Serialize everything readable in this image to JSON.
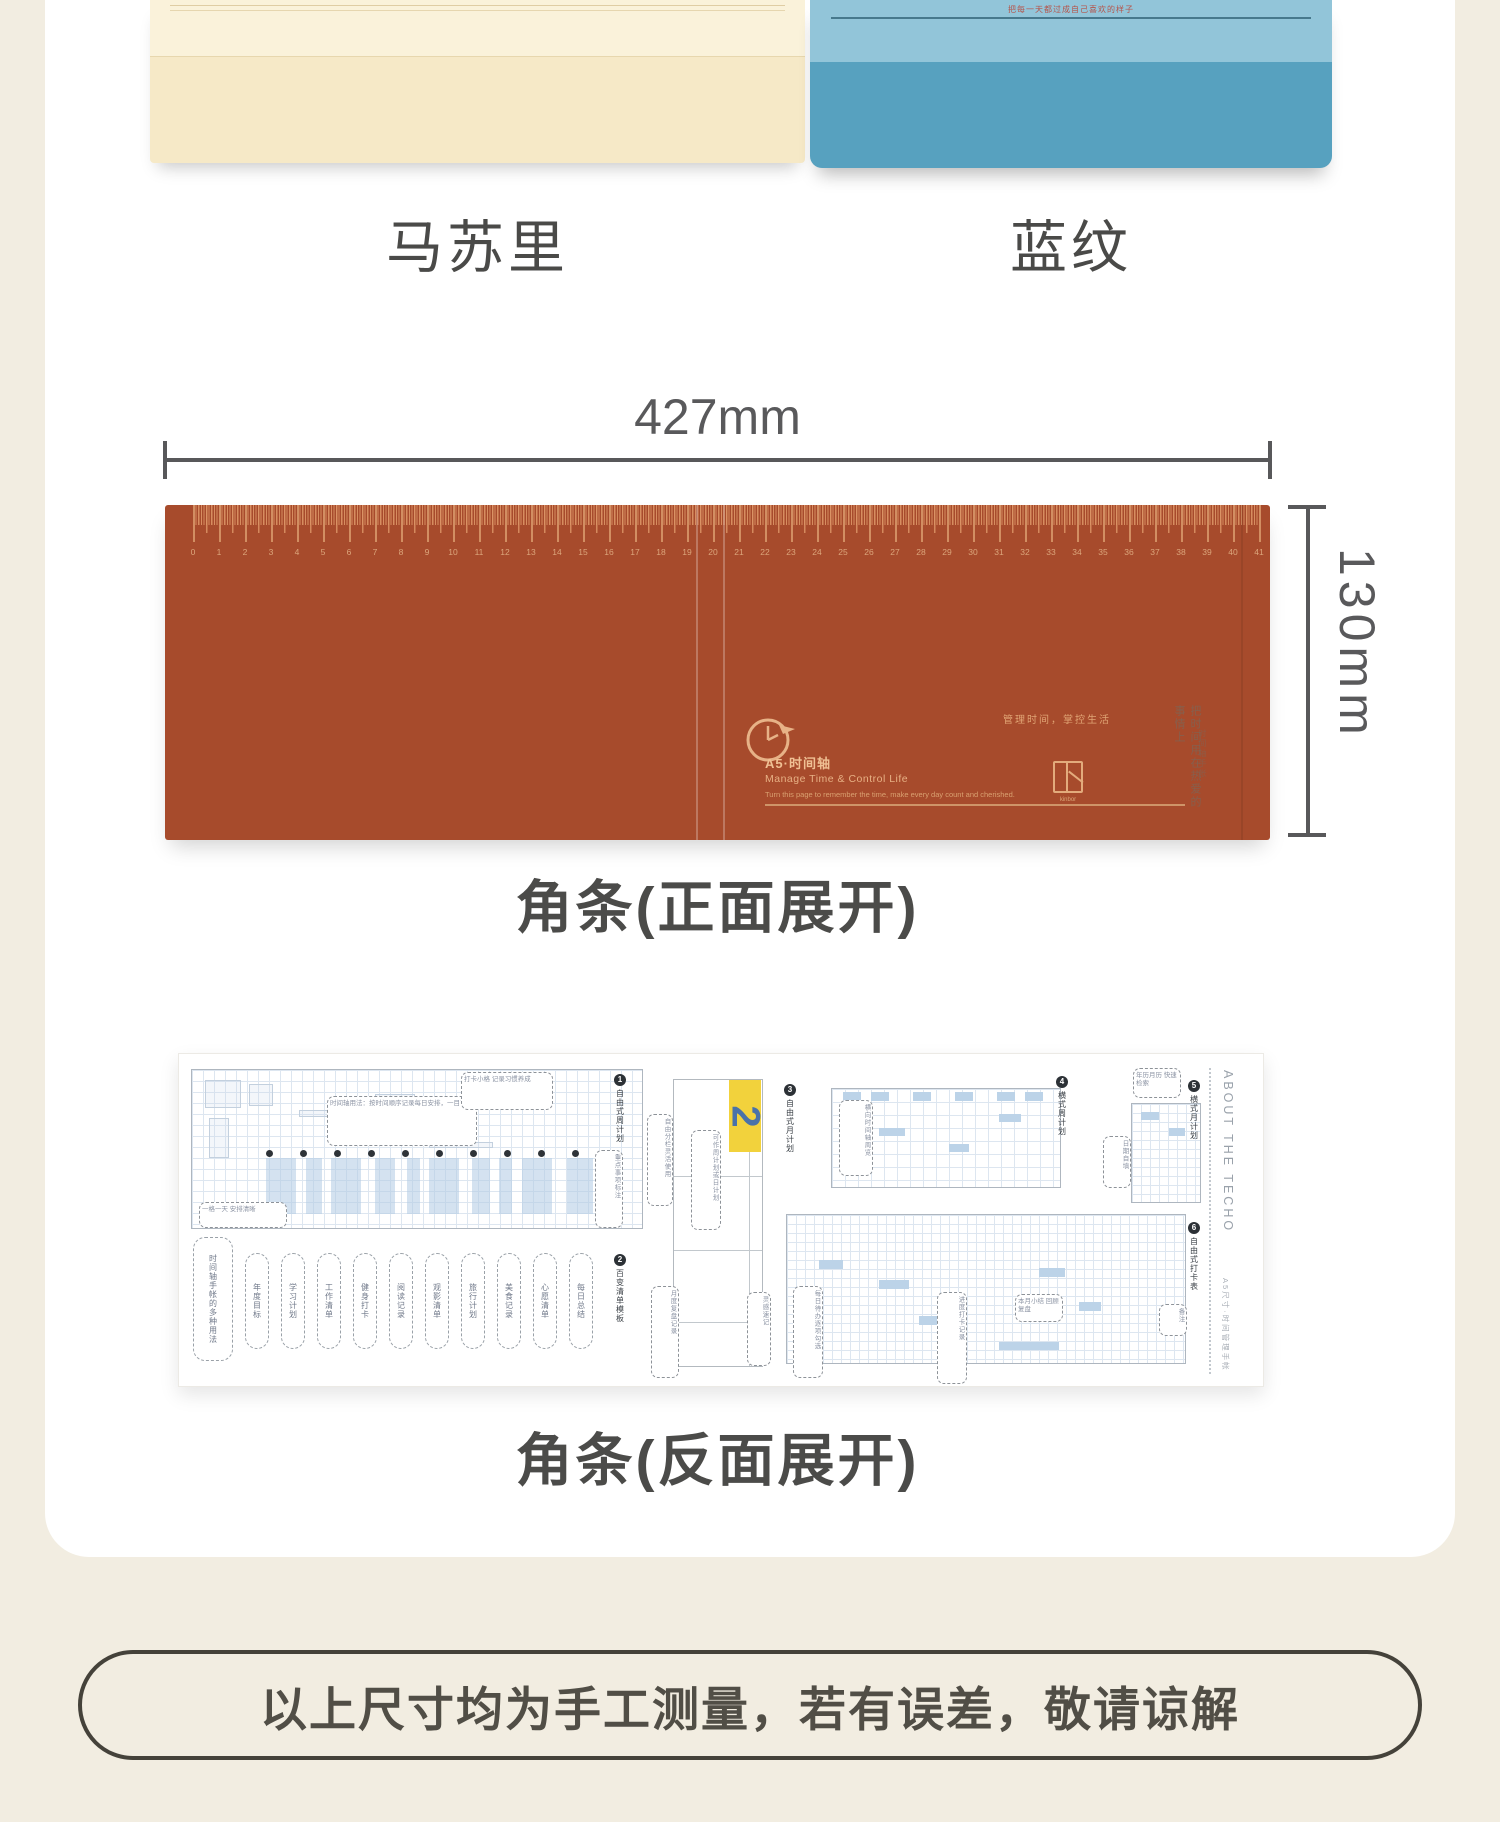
{
  "products": {
    "items": [
      {
        "label": "马苏里"
      },
      {
        "label": "蓝纹",
        "cover_text": "把每一天都过成自己喜欢的样子",
        "cover_tag": "TIP"
      }
    ]
  },
  "front": {
    "width_label": "427mm",
    "height_label": "130mm",
    "caption": "角条(正面展开)",
    "strip_color": "#a74b2c",
    "ruler": {
      "numbers": [
        0,
        1,
        2,
        3,
        4,
        5,
        6,
        7,
        8,
        9,
        10,
        11,
        12,
        13,
        14,
        15,
        16,
        17,
        18,
        19,
        20,
        21,
        22,
        23,
        24,
        25,
        26,
        27,
        28,
        29,
        30,
        31,
        32,
        33,
        34,
        35,
        36,
        37,
        38,
        39,
        40,
        41
      ],
      "step_px": 26
    },
    "print": {
      "title_cn": "A5·时间轴",
      "title_en": "Manage Time & Control Life",
      "subtitle_en": "Turn this page to remember the time, make every day count and cherished.",
      "slogan": "管理时间，掌控生活",
      "vertical_note": "把时间用在热爱的事情上",
      "vertical_note_small": "时间轴手帐",
      "logo_text": "kinbor"
    }
  },
  "backside": {
    "caption": "角条(反面展开)",
    "about_title": "ABOUT THE TECHO",
    "about_sub": "A5尺寸·时间管理手帐",
    "yellow": {
      "label": "2",
      "color": "#f2d23c"
    },
    "midpanel": {
      "x": 494,
      "y": 25,
      "w": 90,
      "h": 288,
      "dividers": [
        96,
        170,
        242
      ]
    },
    "grids": [
      {
        "x": 12,
        "y": 15,
        "w": 452,
        "h": 160,
        "cell": 11
      },
      {
        "x": 652,
        "y": 34,
        "w": 230,
        "h": 100,
        "cell": 13
      },
      {
        "x": 607,
        "y": 160,
        "w": 400,
        "h": 150,
        "cell": 9
      },
      {
        "x": 952,
        "y": 49,
        "w": 70,
        "h": 100,
        "cell": 9
      }
    ],
    "dots": {
      "y": 96,
      "start": 87,
      "step": 34,
      "count": 11
    },
    "bands": [
      {
        "x": 87,
        "w": 30
      },
      {
        "x": 127,
        "w": 16
      },
      {
        "x": 152,
        "w": 30
      },
      {
        "x": 196,
        "w": 20
      },
      {
        "x": 228,
        "w": 13
      },
      {
        "x": 250,
        "w": 30
      },
      {
        "x": 293,
        "w": 18
      },
      {
        "x": 320,
        "w": 13
      },
      {
        "x": 343,
        "w": 30
      },
      {
        "x": 388,
        "w": 26
      },
      {
        "x": 425,
        "w": 14
      }
    ],
    "band_y": 104,
    "band_h": 56,
    "bluecells": [
      {
        "x": 664,
        "y": 38,
        "w": 18,
        "h": 9
      },
      {
        "x": 692,
        "y": 38,
        "w": 18,
        "h": 9
      },
      {
        "x": 734,
        "y": 38,
        "w": 18,
        "h": 9
      },
      {
        "x": 776,
        "y": 38,
        "w": 18,
        "h": 9
      },
      {
        "x": 818,
        "y": 38,
        "w": 18,
        "h": 9
      },
      {
        "x": 846,
        "y": 38,
        "w": 18,
        "h": 9
      },
      {
        "x": 700,
        "y": 74,
        "w": 26,
        "h": 8
      },
      {
        "x": 770,
        "y": 90,
        "w": 20,
        "h": 8
      },
      {
        "x": 820,
        "y": 60,
        "w": 22,
        "h": 8
      },
      {
        "x": 640,
        "y": 206,
        "w": 24,
        "h": 9
      },
      {
        "x": 700,
        "y": 226,
        "w": 30,
        "h": 9
      },
      {
        "x": 860,
        "y": 214,
        "w": 26,
        "h": 9
      },
      {
        "x": 900,
        "y": 248,
        "w": 22,
        "h": 9
      },
      {
        "x": 740,
        "y": 262,
        "w": 34,
        "h": 9
      },
      {
        "x": 820,
        "y": 288,
        "w": 60,
        "h": 8
      },
      {
        "x": 962,
        "y": 58,
        "w": 18,
        "h": 8
      },
      {
        "x": 990,
        "y": 74,
        "w": 16,
        "h": 8
      }
    ],
    "doodles": [
      {
        "x": 26,
        "y": 26,
        "w": 36,
        "h": 28
      },
      {
        "x": 70,
        "y": 30,
        "w": 24,
        "h": 22
      },
      {
        "x": 30,
        "y": 64,
        "w": 20,
        "h": 40
      },
      {
        "x": 120,
        "y": 56,
        "w": 48,
        "h": 7
      },
      {
        "x": 196,
        "y": 40,
        "w": 40,
        "h": 30
      },
      {
        "x": 250,
        "y": 88,
        "w": 64,
        "h": 6
      },
      {
        "x": 330,
        "y": 36,
        "w": 18,
        "h": 14
      }
    ],
    "capsules": [
      {
        "x": 14,
        "y": 183,
        "w": 40,
        "h": 124,
        "text": "时间轴手帐的多种用法"
      },
      {
        "x": 66,
        "y": 199,
        "w": 24,
        "h": 96,
        "text": "年度目标"
      },
      {
        "x": 102,
        "y": 199,
        "w": 24,
        "h": 96,
        "text": "学习计划"
      },
      {
        "x": 138,
        "y": 199,
        "w": 24,
        "h": 96,
        "text": "工作清单"
      },
      {
        "x": 174,
        "y": 199,
        "w": 24,
        "h": 96,
        "text": "健身打卡"
      },
      {
        "x": 210,
        "y": 199,
        "w": 24,
        "h": 96,
        "text": "阅读记录"
      },
      {
        "x": 246,
        "y": 199,
        "w": 24,
        "h": 96,
        "text": "观影清单"
      },
      {
        "x": 282,
        "y": 199,
        "w": 24,
        "h": 96,
        "text": "旅行计划"
      },
      {
        "x": 318,
        "y": 199,
        "w": 24,
        "h": 96,
        "text": "美食记录"
      },
      {
        "x": 354,
        "y": 199,
        "w": 24,
        "h": 96,
        "text": "心愿清单"
      },
      {
        "x": 390,
        "y": 199,
        "w": 24,
        "h": 96,
        "text": "每日总结"
      }
    ],
    "callouts": [
      {
        "x": 148,
        "y": 42,
        "w": 150,
        "h": 50,
        "text": "时间轴用法：按时间顺序记录每日安排，一目了然"
      },
      {
        "x": 282,
        "y": 18,
        "w": 92,
        "h": 38,
        "text": "打卡小格 记录习惯养成"
      },
      {
        "x": 20,
        "y": 148,
        "w": 88,
        "h": 26,
        "text": "一格一天 安排清晰"
      },
      {
        "x": 416,
        "y": 96,
        "w": 28,
        "h": 78,
        "v": true,
        "text": "重点事项标注"
      },
      {
        "x": 468,
        "y": 60,
        "w": 26,
        "h": 92,
        "v": true,
        "text": "自由分栏灵活使用"
      },
      {
        "x": 512,
        "y": 76,
        "w": 30,
        "h": 100,
        "v": true,
        "text": "可作周计划或日计划"
      },
      {
        "x": 472,
        "y": 232,
        "w": 28,
        "h": 92,
        "v": true,
        "text": "月度复盘记录"
      },
      {
        "x": 568,
        "y": 238,
        "w": 24,
        "h": 74,
        "v": true,
        "text": "灵感速记"
      },
      {
        "x": 660,
        "y": 46,
        "w": 34,
        "h": 76,
        "v": true,
        "text": "横向时间轴周览"
      },
      {
        "x": 614,
        "y": 232,
        "w": 30,
        "h": 92,
        "v": true,
        "text": "每日待办逐项勾选"
      },
      {
        "x": 758,
        "y": 238,
        "w": 30,
        "h": 92,
        "v": true,
        "text": "进度打卡记录"
      },
      {
        "x": 836,
        "y": 240,
        "w": 48,
        "h": 28,
        "text": "本月小结 回顾复盘"
      },
      {
        "x": 954,
        "y": 14,
        "w": 48,
        "h": 30,
        "text": "年历月历 快速检索"
      },
      {
        "x": 924,
        "y": 82,
        "w": 28,
        "h": 52,
        "v": true,
        "text": "日期自填"
      },
      {
        "x": 980,
        "y": 250,
        "w": 28,
        "h": 32,
        "v": true,
        "text": "备注"
      }
    ],
    "section_labels": [
      {
        "x": 434,
        "y": 20,
        "num": "1",
        "text": "自由式周计划"
      },
      {
        "x": 434,
        "y": 200,
        "num": "2",
        "text": "百变清单模板"
      },
      {
        "x": 604,
        "y": 30,
        "num": "3",
        "text": "自由式月计划"
      },
      {
        "x": 876,
        "y": 22,
        "num": "4",
        "text": "横式周计划"
      },
      {
        "x": 1008,
        "y": 26,
        "num": "5",
        "text": "横式月计划"
      },
      {
        "x": 1008,
        "y": 168,
        "num": "6",
        "text": "自由式打卡表"
      }
    ]
  },
  "footer": {
    "note": "以上尺寸均为手工测量，若有误差，敬请谅解"
  }
}
